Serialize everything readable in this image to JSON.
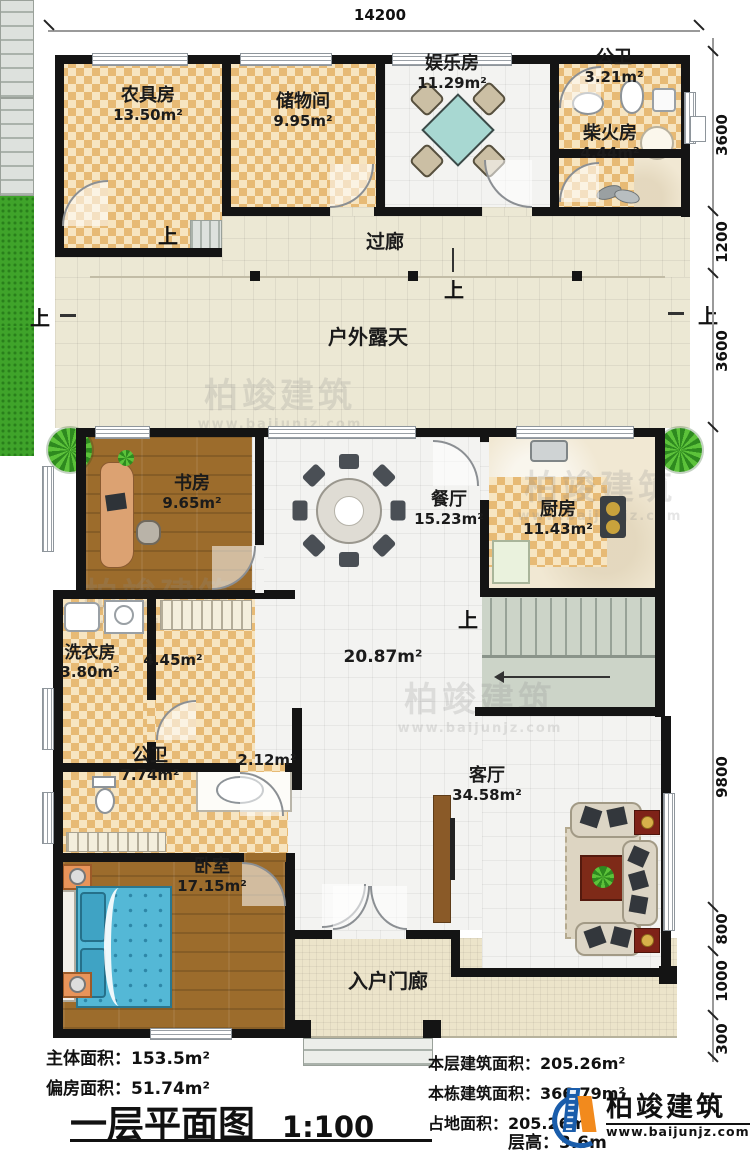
{
  "dimensions": {
    "top": "14200",
    "right": [
      "3600",
      "1200",
      "3600",
      "9800",
      "800",
      "1000",
      "300"
    ]
  },
  "rooms": {
    "farm_tool": {
      "name": "农具房",
      "area": "13.50m²"
    },
    "storage": {
      "name": "储物间",
      "area": "9.95m²"
    },
    "entertainment": {
      "name": "娱乐房",
      "area": "11.29m²"
    },
    "bath_top": {
      "name": "公卫",
      "area": "3.21m²"
    },
    "firewood": {
      "name": "柴火房",
      "area": "4.44m²"
    },
    "corridor": {
      "name": "过廊"
    },
    "outdoor": {
      "name": "户外露天"
    },
    "study": {
      "name": "书房",
      "area": "9.65m²"
    },
    "dining": {
      "name": "餐厅",
      "area": "15.23m²"
    },
    "kitchen": {
      "name": "厨房",
      "area": "11.43m²"
    },
    "laundry": {
      "name": "洗衣房",
      "area": "3.80m²"
    },
    "hall": {
      "area": "4.45m²"
    },
    "great_hall": {
      "area": "20.87m²"
    },
    "passage": {
      "area": "2.12m²"
    },
    "bath_main": {
      "name": "公卫",
      "area": "7.74m²"
    },
    "bedroom": {
      "name": "卧室",
      "area": "17.15m²"
    },
    "living": {
      "name": "客厅",
      "area": "34.58m²"
    },
    "porch": {
      "name": "入户门廊"
    }
  },
  "labels": {
    "up": "上"
  },
  "watermark": {
    "brand": "柏竣建筑",
    "url": "www.baijunjz.com"
  },
  "title_block": {
    "main_area_label": "主体面积：",
    "main_area_value": "153.5m²",
    "annex_area_label": "偏房面积：",
    "annex_area_value": "51.74m²",
    "plan_title": "一层平面图",
    "scale": "1:100",
    "floor_area_label": "本层建筑面积：",
    "floor_area_value": "205.26m²",
    "building_area_label": "本栋建筑面积：",
    "building_area_value": "366.79m²",
    "footprint_label": "占地面积：",
    "footprint_value": "205.26m²",
    "floor_height_label": "层高：",
    "floor_height_value": "3.6m"
  },
  "logo": {
    "brand": "柏竣建筑",
    "url": "www.baijunjz.com"
  }
}
